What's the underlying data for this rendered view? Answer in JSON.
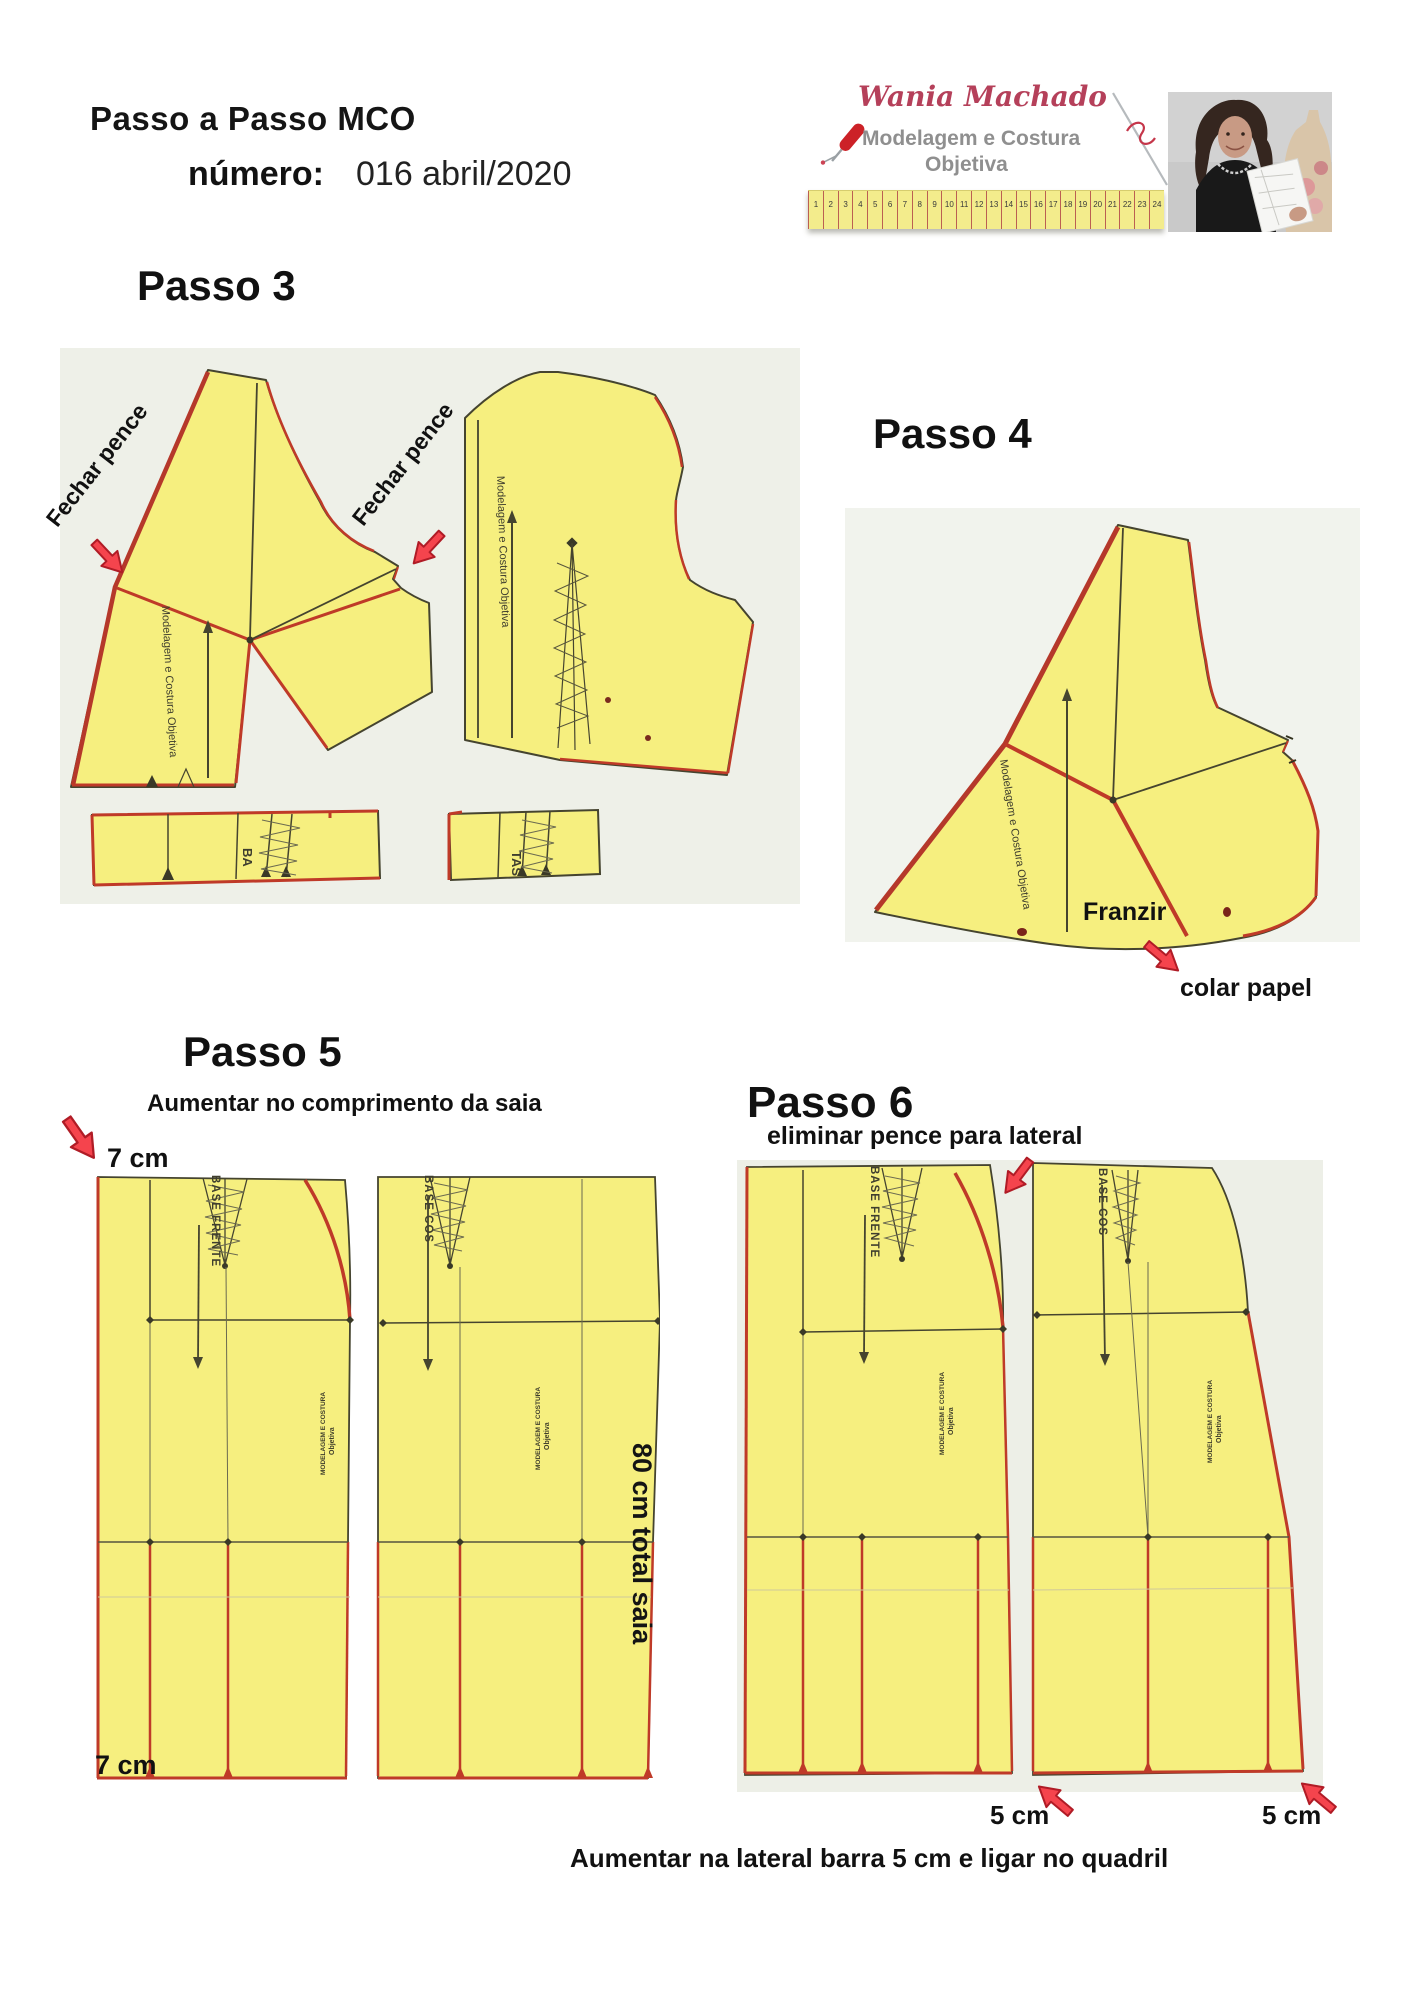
{
  "header": {
    "title": "Passo a Passo MCO",
    "number_label": "número:",
    "number_value": "016 abril/2020"
  },
  "logo": {
    "script_name": "Wania Machado",
    "tagline_line1": "Modelagem e Costura",
    "tagline_line2": "Objetiva",
    "ruler_numbers": [
      "1",
      "2",
      "3",
      "4",
      "5",
      "6",
      "7",
      "8",
      "9",
      "10",
      "11",
      "12",
      "13",
      "14",
      "15",
      "16",
      "17",
      "18",
      "19",
      "20",
      "21",
      "22",
      "23",
      "24"
    ]
  },
  "watermark": {
    "vertical_brand": "Modelagem e Costura Objetiva",
    "stamp_line1": "MODELAGEM E COSTURA",
    "stamp_line2": "Objetiva"
  },
  "passo3": {
    "heading": "Passo 3",
    "fechar_pence_left": "Fechar pence",
    "fechar_pence_right": "Fechar pence",
    "strip1_label": "BA",
    "strip2_label": "TAS"
  },
  "passo4": {
    "heading": "Passo 4",
    "franzir_label": "Franzir",
    "colar_papel_label": "colar papel"
  },
  "passo5": {
    "heading": "Passo 5",
    "subtitle": "Aumentar no comprimento da saia",
    "cm_top": "7 cm",
    "cm_bottom": "7 cm",
    "total_label": "80 cm total saia",
    "front_piece_label": "BASE FRENTE",
    "back_piece_label": "BASE COS"
  },
  "passo6": {
    "heading": "Passo 6",
    "subtitle": "eliminar pence para lateral",
    "cm_left": "5 cm",
    "cm_right": "5 cm",
    "caption": "Aumentar na lateral barra 5 cm e ligar no quadril",
    "front_piece_label": "BASE FRENTE",
    "back_piece_label": "BASE COS"
  },
  "colors": {
    "paper_yellow": "#f6ef7f",
    "pattern_red": "#bf3a28",
    "annotation_red": "#f5444d",
    "outline_olive": "#45442f",
    "logo_red": "#b5405a",
    "logo_gray": "#8f8f8f"
  }
}
